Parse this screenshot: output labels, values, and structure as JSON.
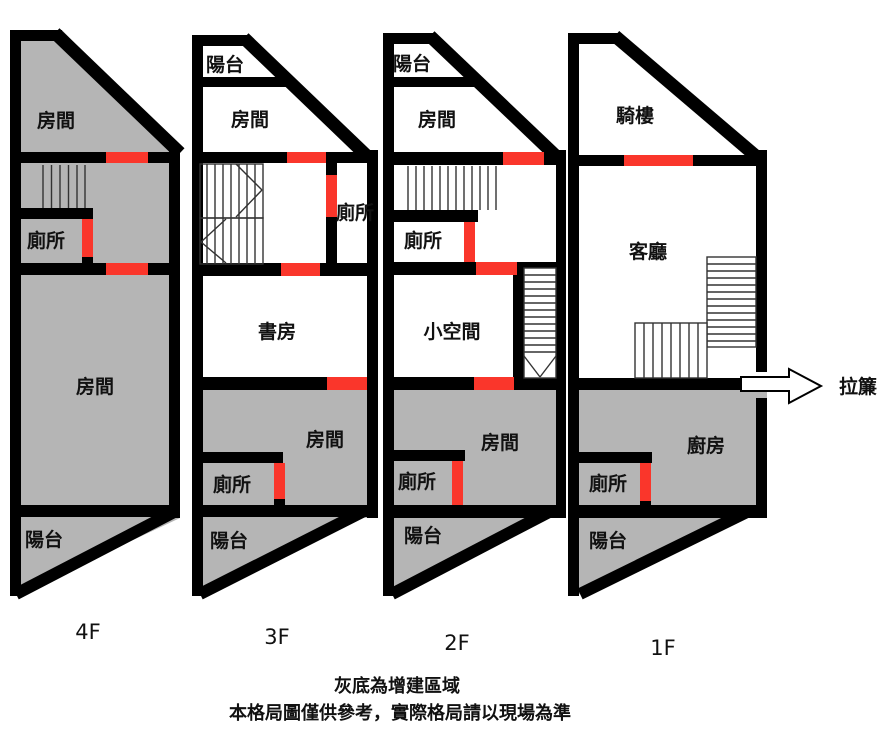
{
  "floors": {
    "f4": {
      "label": "4F",
      "rooms": {
        "room_top": "房間",
        "toilet": "廁所",
        "room_main": "房間",
        "balcony": "陽台"
      }
    },
    "f3": {
      "label": "3F",
      "rooms": {
        "balcony_top": "陽台",
        "room_top": "房間",
        "toilet_mid": "廁所",
        "study": "書房",
        "room_main": "房間",
        "toilet_low": "廁所",
        "balcony": "陽台"
      }
    },
    "f2": {
      "label": "2F",
      "rooms": {
        "balcony_top": "陽台",
        "room_top": "房間",
        "toilet_mid": "廁所",
        "small_space": "小空間",
        "room_main": "房間",
        "toilet_low": "廁所",
        "balcony": "陽台"
      }
    },
    "f1": {
      "label": "1F",
      "rooms": {
        "arcade": "騎樓",
        "living": "客廳",
        "kitchen": "廚房",
        "toilet": "廁所",
        "balcony": "陽台"
      },
      "curtain_label": "拉簾"
    }
  },
  "notes": {
    "line1": "灰底為增建區域",
    "line2": "本格局圖僅供參考，實際格局請以現場為準"
  },
  "colors": {
    "wall": "#000000",
    "annex_gray": "#b5b5b5",
    "door_red": "#fa362b",
    "background": "#ffffff"
  }
}
